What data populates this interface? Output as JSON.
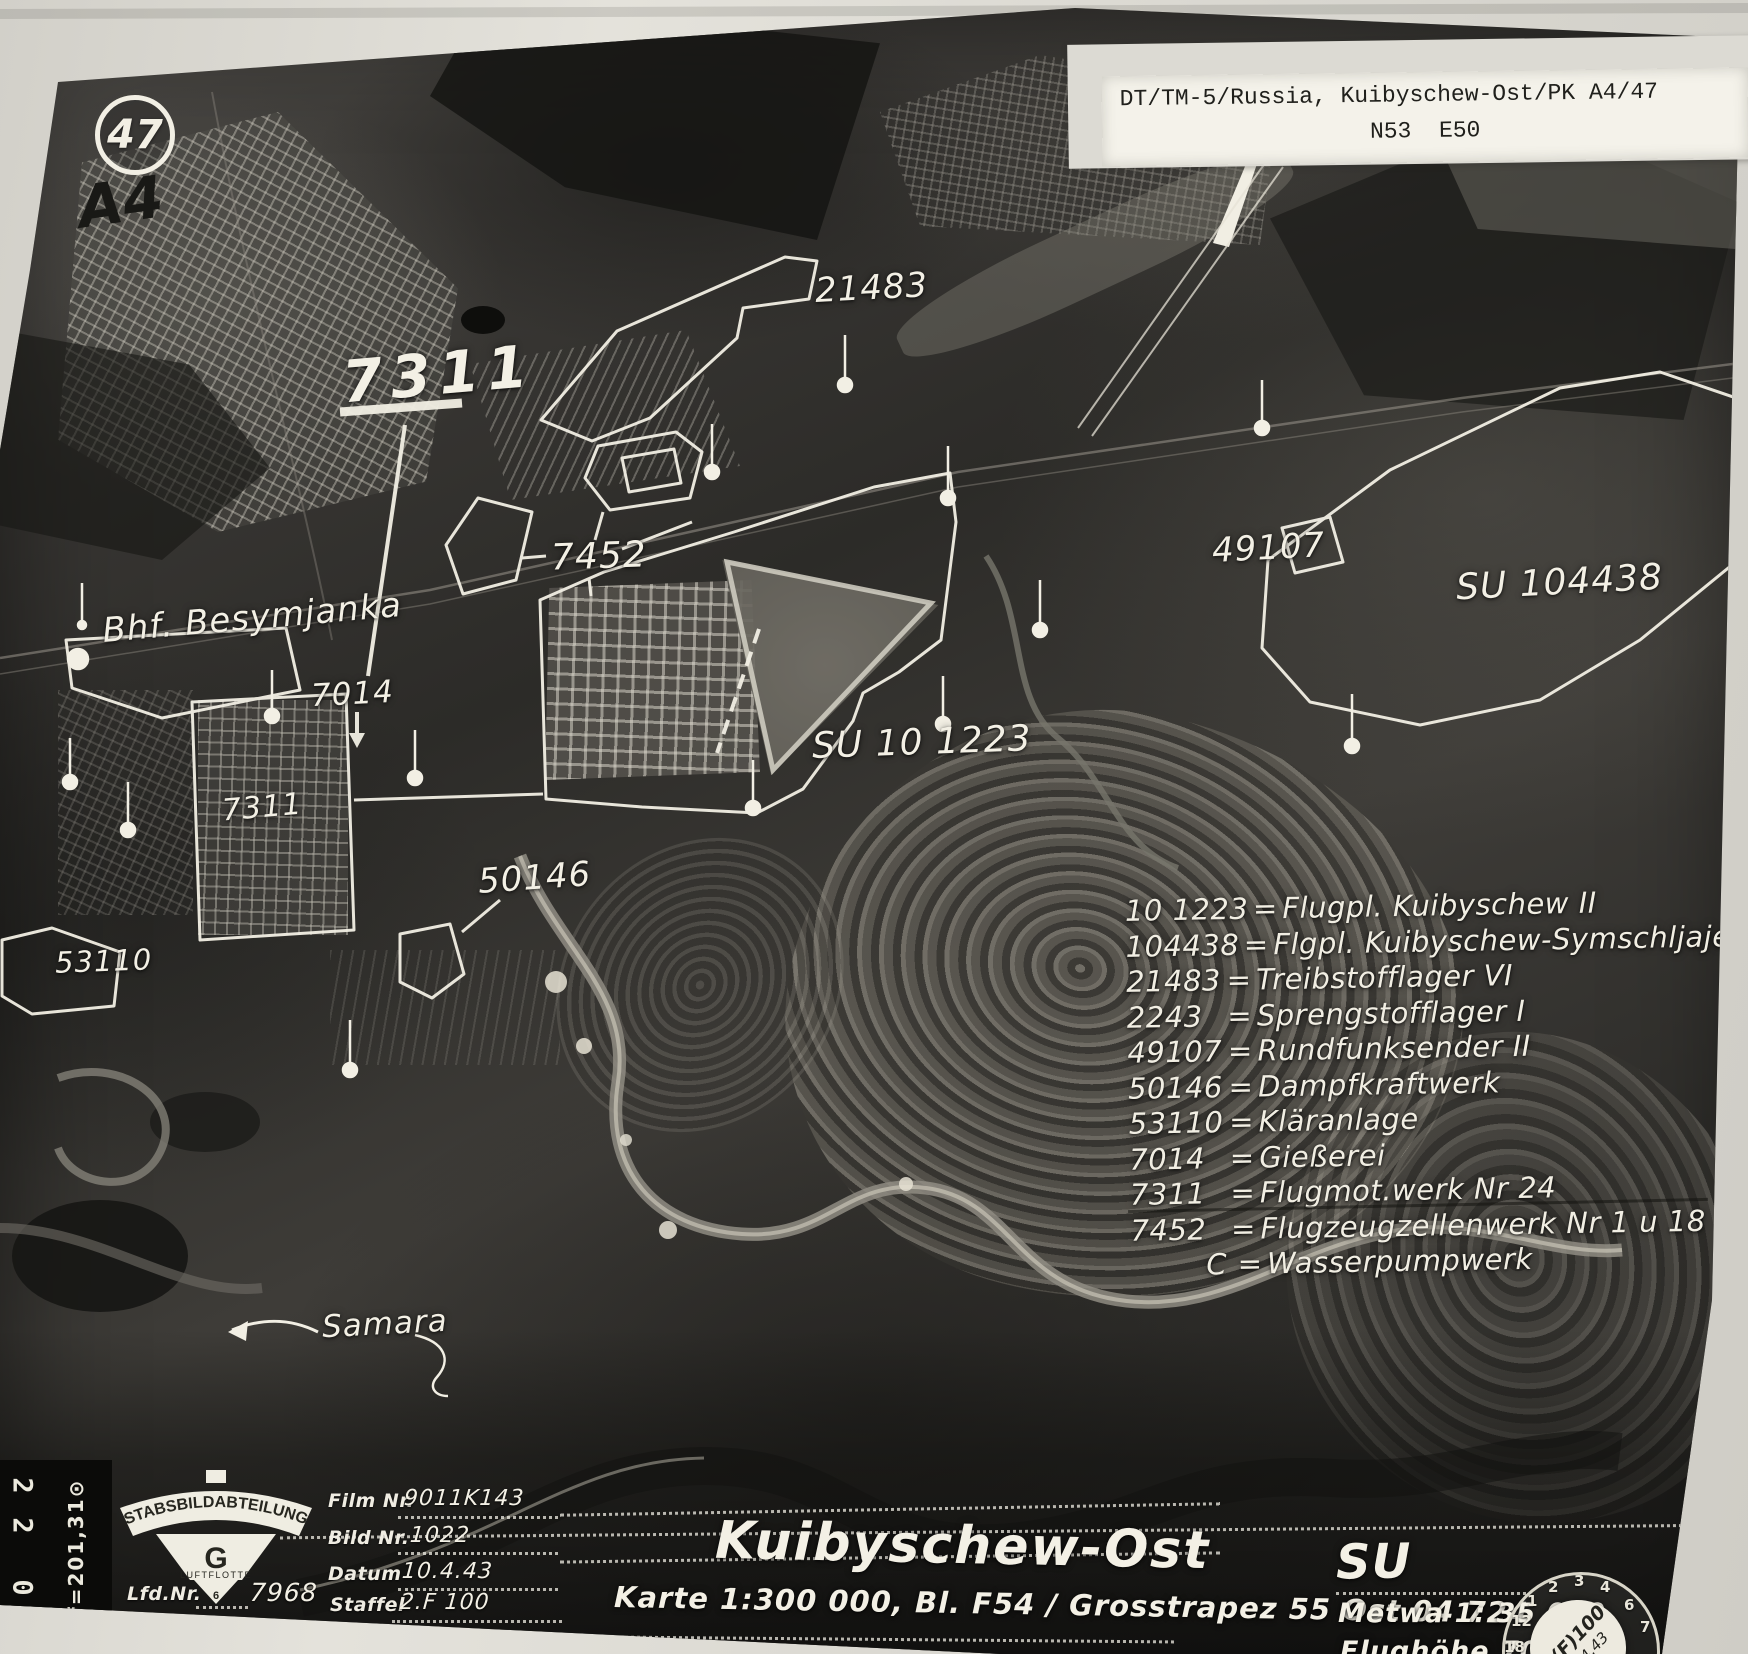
{
  "corner": {
    "circle_number": "47",
    "pencil_mark": "A4"
  },
  "header_card": {
    "line1": "DT/TM-5/Russia, Kuibyschew-Ost/PK A4/47",
    "line2": "N53  E50"
  },
  "map_labels": {
    "l21483": "21483",
    "l7311_big": "7311",
    "l7452": "7452",
    "bahnhof": "Bhf. Besymjanka",
    "l7014": "7014",
    "su101223": "SU 10 1223",
    "l49107": "49107",
    "su104438": "SU 104438",
    "l7311_small": "7311",
    "l50146": "50146",
    "l53110": "53110",
    "river": "Samara"
  },
  "legend_eq": "=",
  "legend": [
    {
      "code": "10 1223",
      "desc": "Flugpl. Kuibyschew II"
    },
    {
      "code": "104438",
      "desc": "Flgpl. Kuibyschew-Symschljajewka"
    },
    {
      "code": "21483",
      "desc": "Treibstofflager VI"
    },
    {
      "code": "2243",
      "desc": "Sprengstofflager I"
    },
    {
      "code": "49107",
      "desc": "Rundfunksender II"
    },
    {
      "code": "50146",
      "desc": "Dampfkraftwerk"
    },
    {
      "code": "53110",
      "desc": "Kläranlage"
    },
    {
      "code": "7014",
      "desc": "Gießerei"
    },
    {
      "code": "7311",
      "desc": "Flugmot.werk Nr 24"
    },
    {
      "code": "7452",
      "desc": "Flugzeugzellenwerk Nr 1 u 18"
    },
    {
      "code": "C",
      "desc": "Wasserpumpwerk"
    }
  ],
  "footer": {
    "stamp": {
      "arc_text": "STABSBILDABTEILUNG",
      "letter": "G",
      "unit": "LUFTFLOTTE",
      "number": "6"
    },
    "lfd_label": "Lfd.Nr.",
    "lfd_value": "7968",
    "film_label": "Film Nr.",
    "film_value": "9011K143",
    "bild_label": "Bild Nr.",
    "bild_value": "1022",
    "datum_label": "Datum",
    "datum_value": "10.4.43",
    "staffel_label": "Staffel",
    "staffel_value": "2.F 100",
    "title": "Kuibyschew-Ost",
    "karte_line": "Karte 1:300 000, Bl. F54  / Grosstrapez 55 Ost 04 724",
    "country": "SU",
    "scale_line": "Metwa 1: 35 000",
    "altitude_line": "Flughöhe 7000 m"
  },
  "film_edge": {
    "digit1": "2",
    "digit2": "2",
    "digit3": "0",
    "focal": "f=201,31⊙"
  },
  "round_stamp": {
    "unit": "2.(F)100",
    "date": "10.4.43",
    "numerals": [
      "12",
      "1",
      "2",
      "3",
      "4",
      "18",
      "7",
      "6"
    ]
  }
}
